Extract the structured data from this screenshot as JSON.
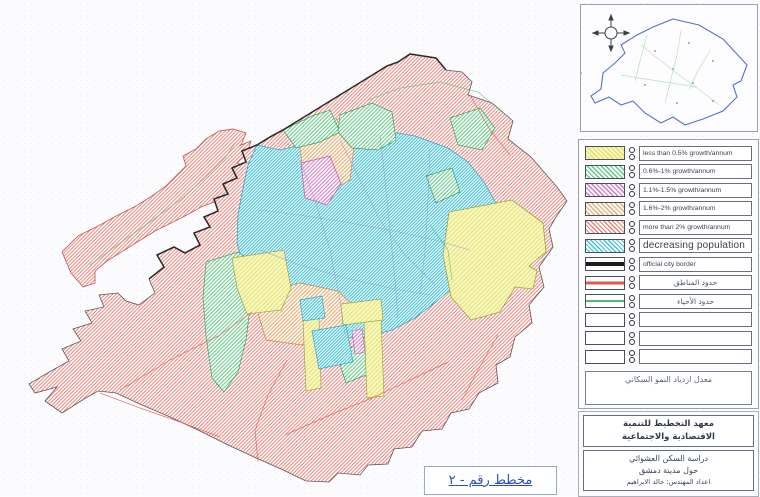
{
  "palette": {
    "yellow": "#e2de6a",
    "yellow_fill": "#f8f7c0",
    "green": "#5bc97f",
    "magenta": "#d873c4",
    "orange": "#edab6e",
    "red": "#ec8078",
    "cyan": "#3ec3dc",
    "black": "#1c1c1c",
    "red_line": "#e25950",
    "green_line": "#49bd6d",
    "inset_blue": "#5470cf",
    "street_blue": "#8ea6cf",
    "plan_label_blue": "#2d4ec2"
  },
  "legend": {
    "items": [
      {
        "swatch": "yellow-hatch",
        "label": "less than 0.5% growth/annum"
      },
      {
        "swatch": "green-hatch",
        "label": "0.6%-1% growth/annum"
      },
      {
        "swatch": "magenta-hatch",
        "label": "1.1%-1.5% growth/annum"
      },
      {
        "swatch": "orange-hatch",
        "label": "1.6%-2% growth/annum"
      },
      {
        "swatch": "red-hatch",
        "label": "more than 2% growth/annum"
      },
      {
        "swatch": "cyan-hatch",
        "label": "decreasing population",
        "emphasis": true
      },
      {
        "swatch": "black-line",
        "label": "official city border"
      },
      {
        "swatch": "red-line",
        "label": "حدود المناطق",
        "rtl": true
      },
      {
        "swatch": "green-line",
        "label": "حدود الأحياء",
        "rtl": true
      },
      {
        "swatch": "empty",
        "label": ""
      },
      {
        "swatch": "empty",
        "label": ""
      },
      {
        "swatch": "empty",
        "label": ""
      }
    ],
    "caption": "معدل ازدياد النمو السكاني"
  },
  "credits": {
    "institute_line1": "معهد التخطيط للتنمية",
    "institute_line2": "الاقتصادية والاجتماعية",
    "study_line1": "دراسة السكن العشوائي",
    "study_line2": "حول مدينة دمشق",
    "study_line3": "اعداد المهندس: خالد الابراهيم"
  },
  "plan_label": "مخطط رقم - ٢"
}
